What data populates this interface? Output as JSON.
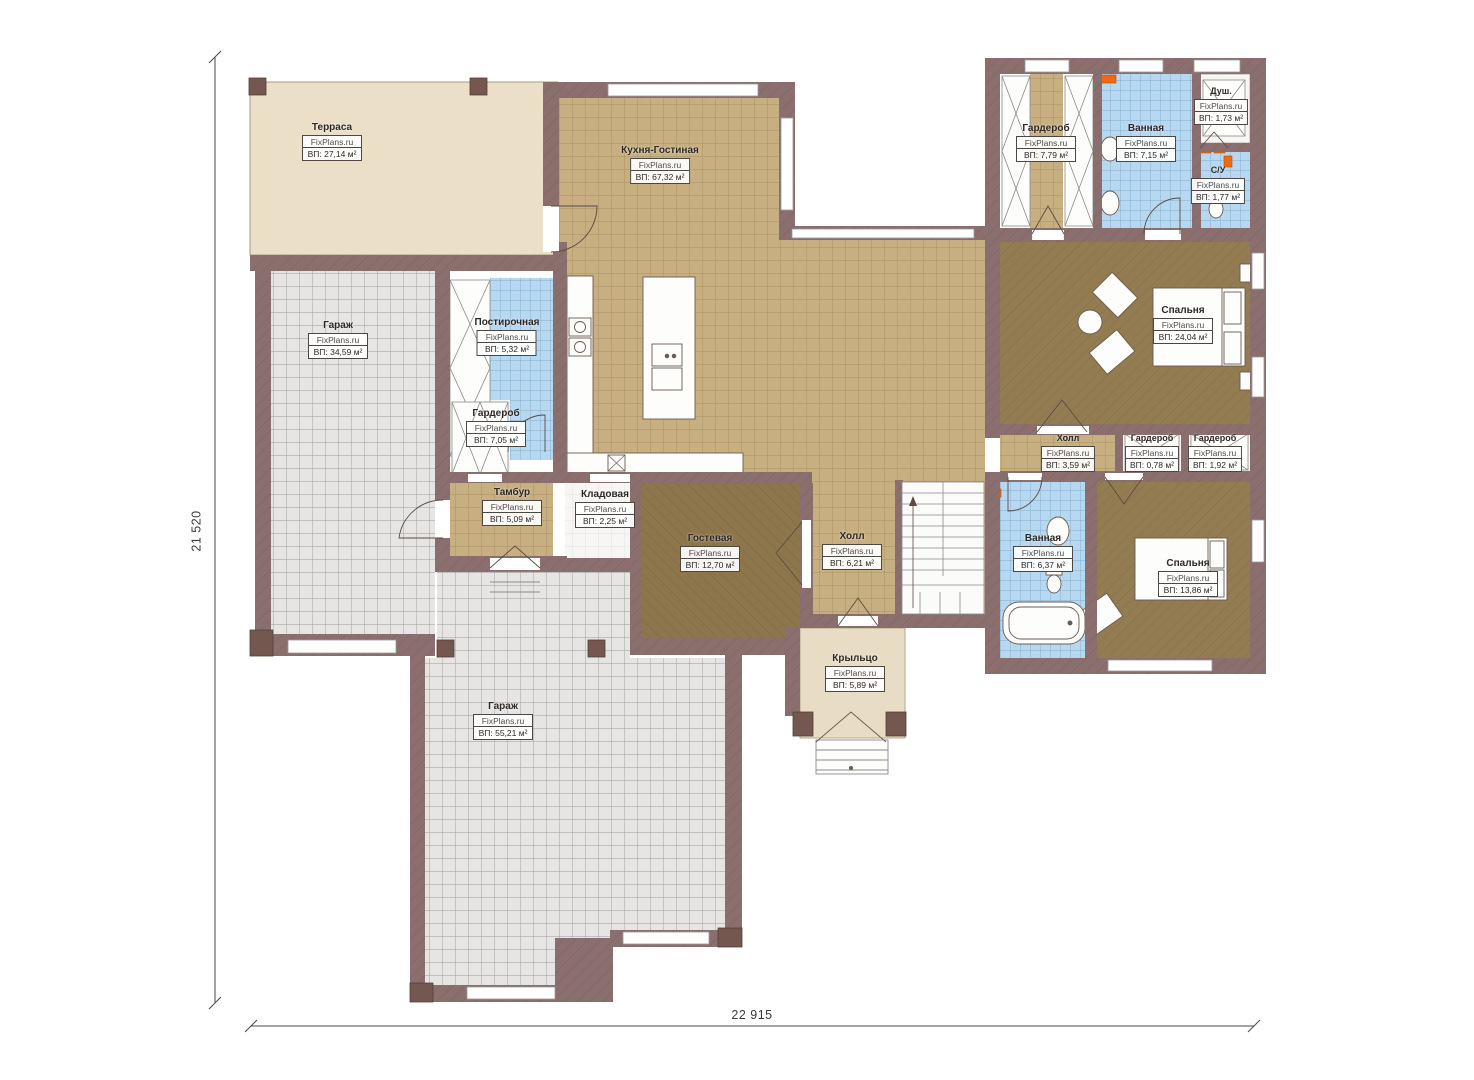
{
  "watermark": "FixPlans.ru",
  "dimensions": {
    "height_label": "21 520",
    "width_label": "22 915"
  },
  "palette": {
    "wall": "#8b6f6f",
    "terrace_floor": "#ebdfc7",
    "kitchen_tile": "#c7af81",
    "garage_floor": "#e6e5e3",
    "bath_tile": "#b7d8f1",
    "bedroom_floor": "#937c52",
    "guest_floor": "#8d764b",
    "porch_floor": "#e8dcc4",
    "fixture_orange": "#ed6a12"
  },
  "rooms": [
    {
      "key": "terrace",
      "name": "Терраса",
      "area": "ВП: 27,14 м²"
    },
    {
      "key": "kitchen_living",
      "name": "Кухня-Гостиная",
      "area": "ВП: 67,32 м²"
    },
    {
      "key": "garage_top",
      "name": "Гараж",
      "area": "ВП: 34,59 м²"
    },
    {
      "key": "laundry",
      "name": "Постирочная",
      "area": "ВП: 5,32 м²"
    },
    {
      "key": "wardrobe_1",
      "name": "Гардероб",
      "area": "ВП: 7,05 м²"
    },
    {
      "key": "tambour",
      "name": "Тамбур",
      "area": "ВП: 5,09 м²"
    },
    {
      "key": "storage",
      "name": "Кладовая",
      "area": "ВП: 2,25 м²"
    },
    {
      "key": "guest_room",
      "name": "Гостевая",
      "area": "ВП: 12,70 м²"
    },
    {
      "key": "hall_main",
      "name": "Холл",
      "area": "ВП: 6,21 м²"
    },
    {
      "key": "garage_bottom",
      "name": "Гараж",
      "area": "ВП: 55,21 м²"
    },
    {
      "key": "porch",
      "name": "Крыльцо",
      "area": "ВП: 5,89 м²"
    },
    {
      "key": "wardrobe_2",
      "name": "Гардероб",
      "area": "ВП: 7,79 м²"
    },
    {
      "key": "bathroom_1",
      "name": "Ванная",
      "area": "ВП: 7,15 м²"
    },
    {
      "key": "shower",
      "name": "Душ.",
      "area": "ВП: 1,73 м²"
    },
    {
      "key": "wc",
      "name": "С/У",
      "area": "ВП: 1,77 м²"
    },
    {
      "key": "bedroom_1",
      "name": "Спальня",
      "area": "ВП: 24,04 м²"
    },
    {
      "key": "hall_2",
      "name": "Холл",
      "area": "ВП: 3,59 м²"
    },
    {
      "key": "wardrobe_3",
      "name": "Гардероб",
      "area": "ВП: 0,78 м²"
    },
    {
      "key": "wardrobe_4",
      "name": "Гардероб",
      "area": "ВП: 1,92 м²"
    },
    {
      "key": "bathroom_2",
      "name": "Ванная",
      "area": "ВП: 6,37 м²"
    },
    {
      "key": "bedroom_2",
      "name": "Спальня",
      "area": "ВП: 13,86 м²"
    }
  ]
}
